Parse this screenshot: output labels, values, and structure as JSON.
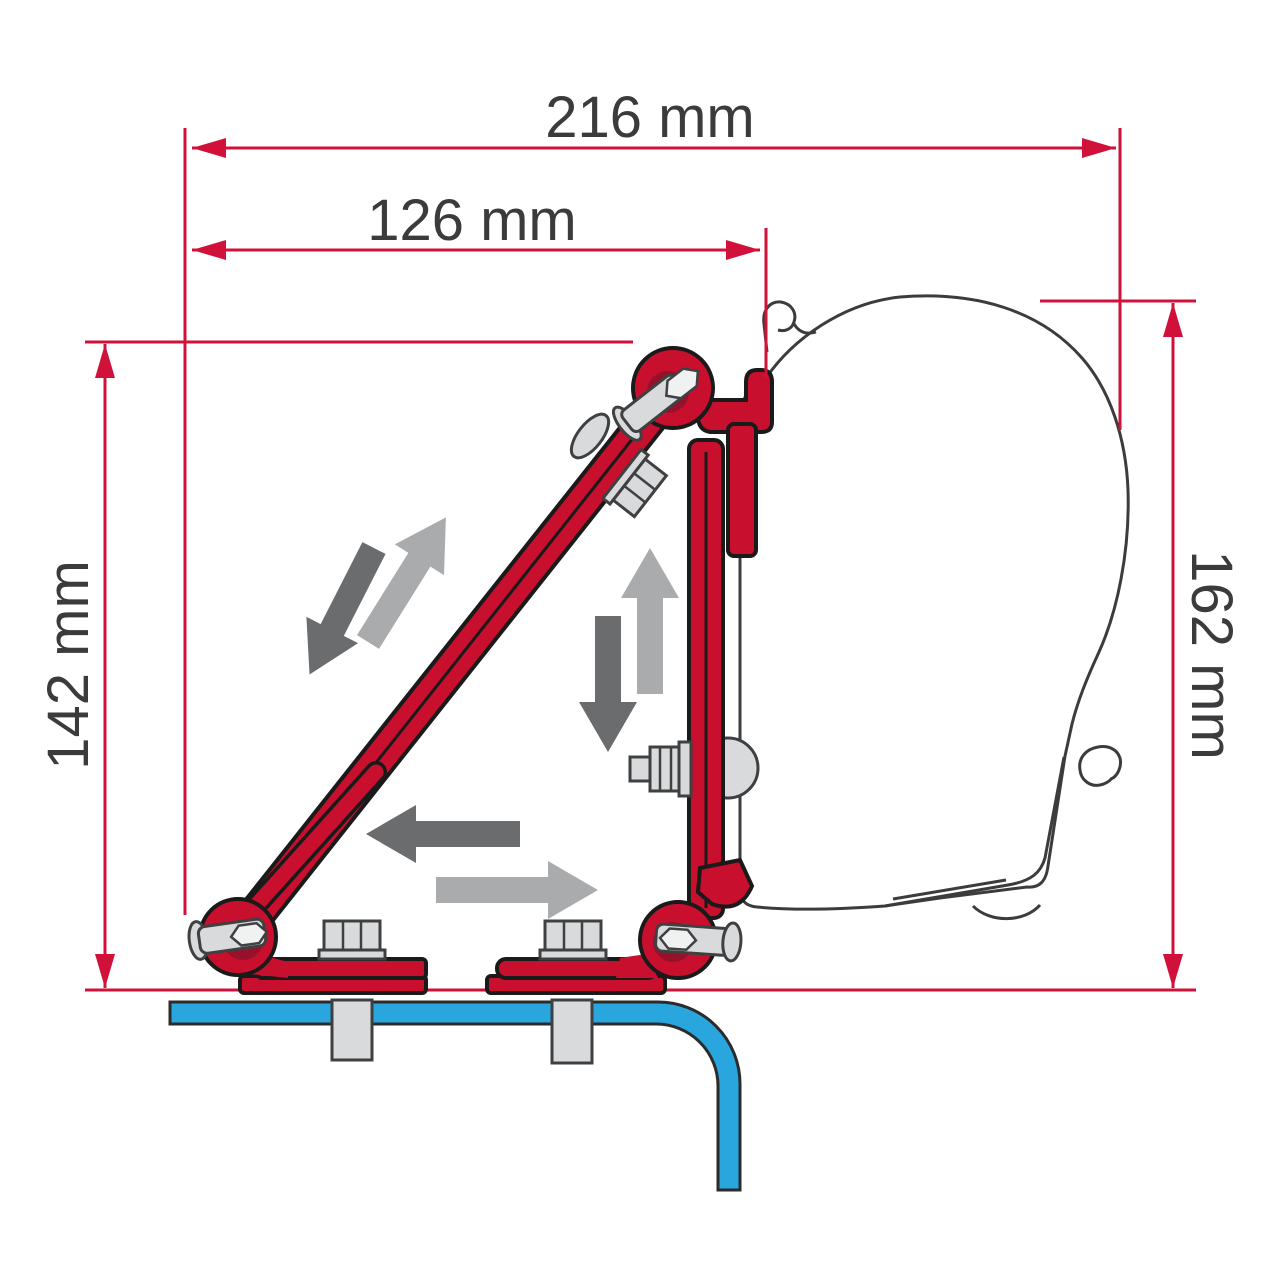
{
  "diagram": {
    "type": "technical-installation-diagram",
    "dimensions": {
      "top_width": {
        "label": "216 mm"
      },
      "inner_width": {
        "label": "126 mm"
      },
      "left_height": {
        "label": "142 mm"
      },
      "right_height": {
        "label": "162 mm"
      }
    },
    "colors": {
      "dimension_red": "#d0123a",
      "bracket_red": "#c8102e",
      "bracket_red_dark": "#97112a",
      "roof_blue": "#2aa6df",
      "arrow_dark": "#6b6c6e",
      "arrow_light": "#a9abad",
      "outline_black": "#1a1a1a",
      "case_outline_gray": "#3c3c3e",
      "metal_gray": "#d9dadb",
      "metal_outline": "#3f4041",
      "text_color": "#3b3b3d"
    },
    "icons": [
      "arrow-up-right-icon",
      "arrow-down-left-icon",
      "arrow-up-icon",
      "arrow-down-icon",
      "arrow-left-icon",
      "arrow-right-icon"
    ]
  }
}
